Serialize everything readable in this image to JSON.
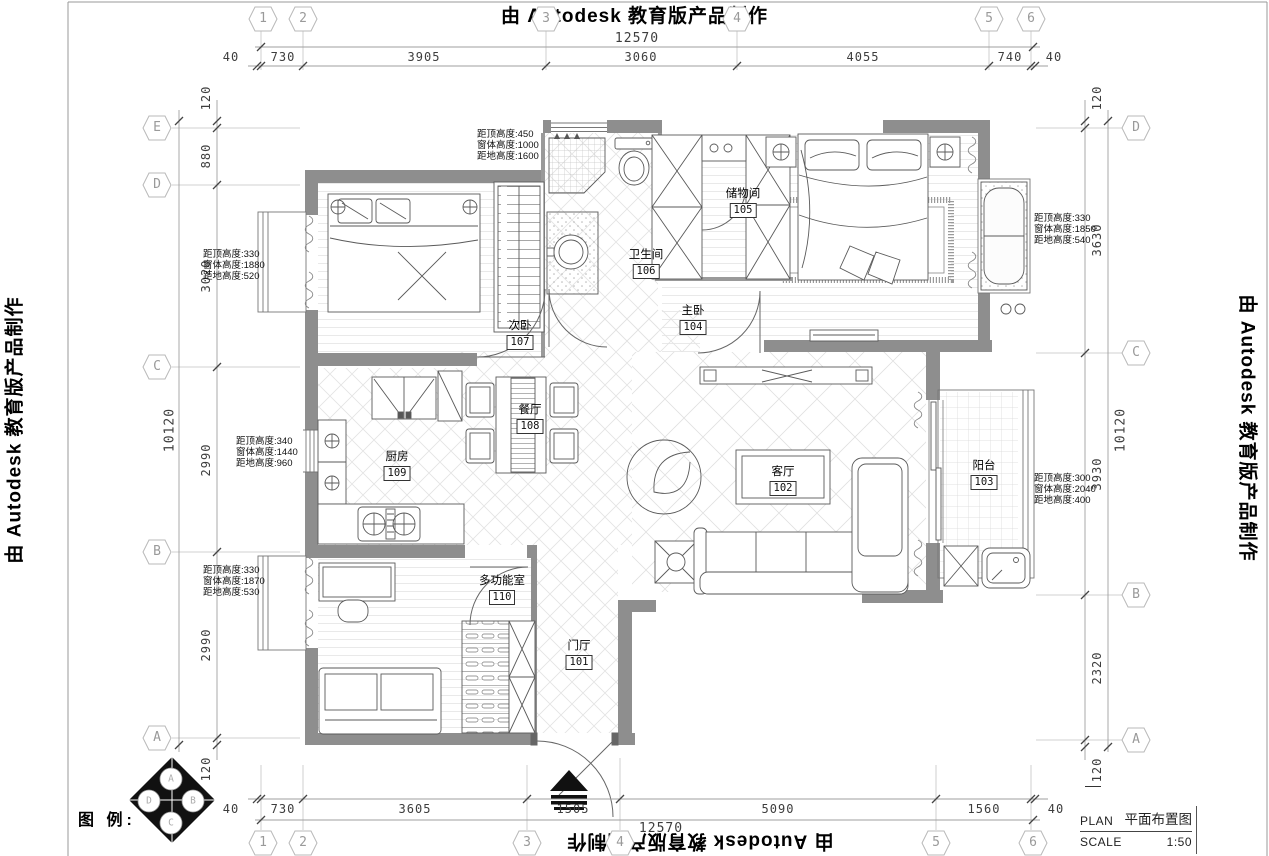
{
  "watermark": {
    "top": "由 Autodesk 教育版产品制作",
    "left": "由 Autodesk 教育版产品制作",
    "right": "由 Autodesk 教育版产品制作",
    "bottom": "由 Autodesk 教育版产品制作"
  },
  "title_block": {
    "plan_label": "PLAN",
    "plan_value": "平面布置图",
    "scale_label": "SCALE",
    "scale_value": "1:50"
  },
  "legend": {
    "label": "图 例:",
    "compass": {
      "top": "A",
      "left": "D",
      "right": "B",
      "bottom": "C"
    }
  },
  "grid_bubbles": {
    "top": [
      "1",
      "2",
      "3",
      "4",
      "5",
      "6"
    ],
    "bottom": [
      "1",
      "2",
      "3",
      "4",
      "5",
      "6"
    ],
    "left": [
      "E",
      "D",
      "C",
      "B",
      "A"
    ],
    "right": [
      "D",
      "C",
      "B",
      "A"
    ]
  },
  "dimensions": {
    "top": {
      "overall": "12570",
      "segments": [
        "40",
        "730",
        "3905",
        "3060",
        "4055",
        "740",
        "40"
      ]
    },
    "bottom": {
      "overall": "12570",
      "segments": [
        "40",
        "730",
        "3605",
        "1505",
        "5090",
        "1560",
        "40"
      ]
    },
    "left": {
      "overall": "10120",
      "segments": [
        "120",
        "880",
        "3020",
        "2990",
        "2990",
        "120"
      ]
    },
    "right": {
      "overall": "10120",
      "segments": [
        "120",
        "3630",
        "3930",
        "2320",
        "120"
      ]
    }
  },
  "rooms": [
    {
      "name": "门厅",
      "number": "101"
    },
    {
      "name": "客厅",
      "number": "102"
    },
    {
      "name": "阳台",
      "number": "103"
    },
    {
      "name": "主卧",
      "number": "104"
    },
    {
      "name": "储物间",
      "number": "105"
    },
    {
      "name": "卫生间",
      "number": "106"
    },
    {
      "name": "次卧",
      "number": "107"
    },
    {
      "name": "餐厅",
      "number": "108"
    },
    {
      "name": "厨房",
      "number": "109"
    },
    {
      "name": "多功能室",
      "number": "110"
    }
  ],
  "window_annotations": [
    {
      "lines": [
        "距顶高度:450",
        "窗体高度:1000",
        "距地高度:1600"
      ]
    },
    {
      "lines": [
        "距顶高度:330",
        "窗体高度:1880",
        "距地高度:520"
      ]
    },
    {
      "lines": [
        "距顶高度:340",
        "窗体高度:1440",
        "距地高度:960"
      ]
    },
    {
      "lines": [
        "距顶高度:330",
        "窗体高度:1870",
        "距地高度:530"
      ]
    },
    {
      "lines": [
        "距顶高度:330",
        "窗体高度:1850",
        "距地高度:540"
      ]
    },
    {
      "lines": [
        "距顶高度:300",
        "窗体高度:2040",
        "距地高度:400"
      ]
    }
  ],
  "colors": {
    "wall": "#8e8e8e",
    "line": "#5a5a5a",
    "dim_text": "#3d3d3d",
    "bubble": "#9a9a9a"
  }
}
